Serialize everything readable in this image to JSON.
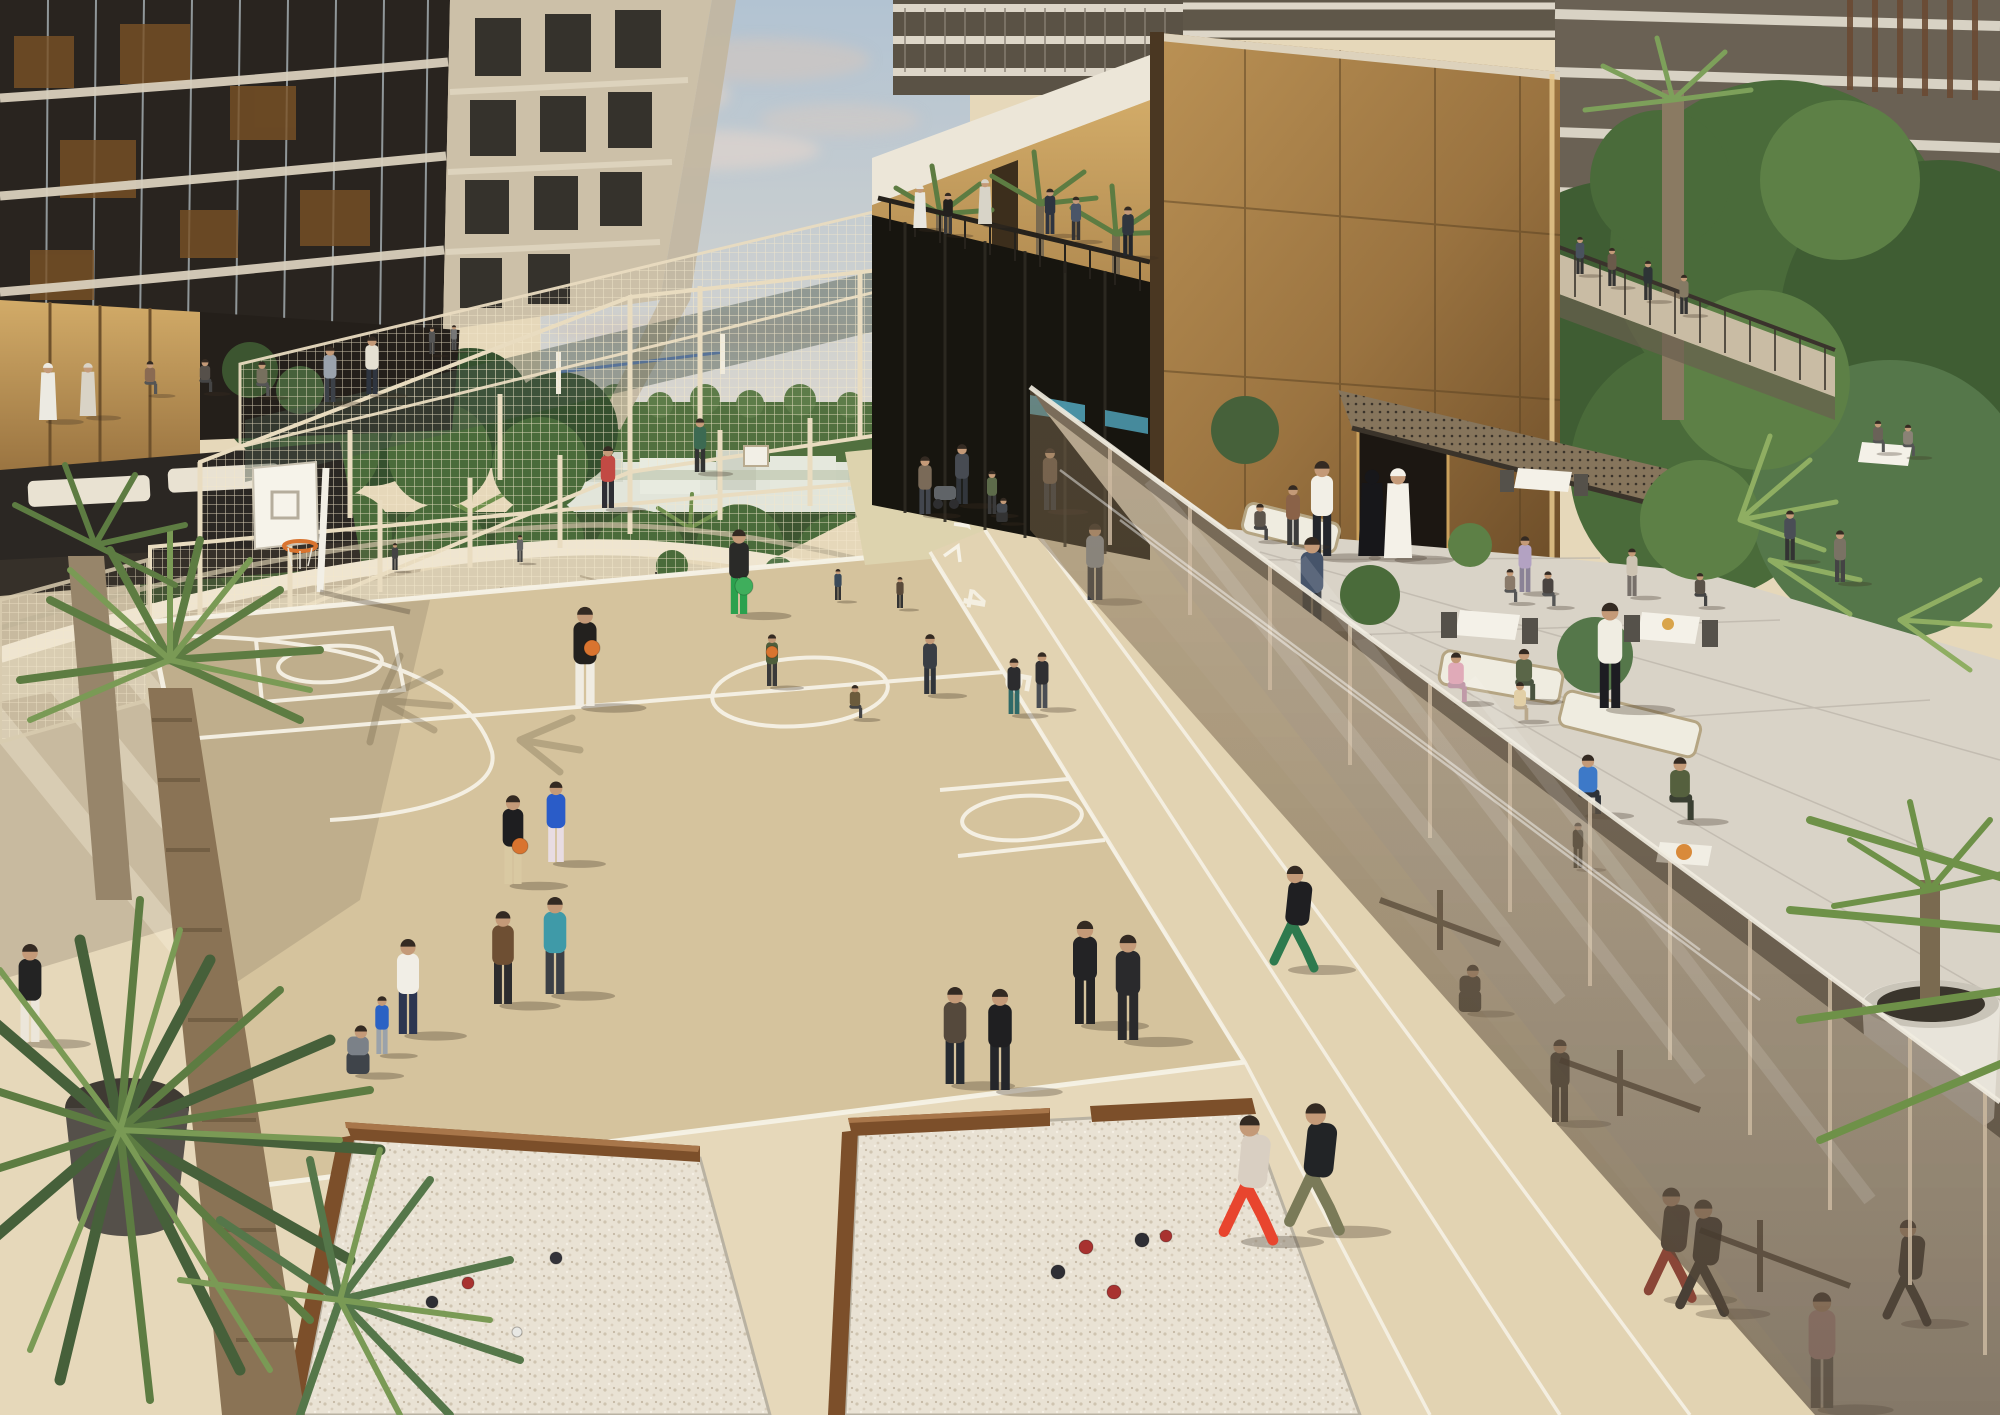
{
  "image": {
    "title": "Rooftop sports and leisure deck - architectural rendering",
    "width": 2000,
    "height": 1415
  },
  "scene": {
    "description": "Aerial rendering of a residential rooftop podium: basketball court with players, fenced padel courts, jogging track with painted lane numbers, two petanque sand pits, palm trees, a bronze pavilion and monolith volume, an outdoor restaurant terrace with diners and waiters behind a tinted glass balustrade, and an outdoor gym seen through the glass.",
    "areas": [
      "basketball-court",
      "padel-courts",
      "running-track",
      "petanque-pits",
      "restaurant-terrace",
      "balcony-pavilion",
      "outdoor-gym",
      "garden-walkway"
    ],
    "track": {
      "lane_numbers": [
        "4",
        "5",
        "3"
      ]
    },
    "palette": {
      "sky_top": "#b2c3d2",
      "sky_low": "#e6dccf",
      "cloud": "#d8cfc9",
      "horizon_green": "#51703f",
      "buildings_far": "#e2e5da",
      "tower_glass": "#29241f",
      "tower_glass_warm": "#7a5226",
      "tower_stone": "#ccc0a8",
      "bronze_light": "#c79e5f",
      "bronze_dark": "#8a6435",
      "canopy_white": "#ece6d8",
      "mesh": "#ecdfc2",
      "deck": "#e6d8ba",
      "court": "#d5c39d",
      "walk_light": "#efe3cb",
      "line_white": "#f6f2e6",
      "glass_tint": "#857258",
      "terrace_stone": "#d9d3c7",
      "sand": "#e9e2d4",
      "wood": "#7c4f2a",
      "pool": "#55c3c6",
      "rim_orange": "#d9742f",
      "palm_green": "#5d7c42",
      "palm_light": "#8fae62",
      "trunk": "#8a7355"
    },
    "balls": [
      {
        "x": 592,
        "y": 648,
        "r": 8,
        "c": "#d9742f"
      },
      {
        "x": 520,
        "y": 846,
        "r": 8,
        "c": "#d9742f"
      },
      {
        "x": 744,
        "y": 586,
        "r": 9,
        "c": "#3fae5c"
      },
      {
        "x": 772,
        "y": 652,
        "r": 6,
        "c": "#d9742f"
      }
    ],
    "boules": [
      {
        "x": 468,
        "y": 1283,
        "r": 6,
        "c": "#a83230"
      },
      {
        "x": 432,
        "y": 1302,
        "r": 6,
        "c": "#2e2e34"
      },
      {
        "x": 517,
        "y": 1332,
        "r": 5,
        "c": "#e8e8e4"
      },
      {
        "x": 556,
        "y": 1258,
        "r": 6,
        "c": "#33333a"
      },
      {
        "x": 1086,
        "y": 1247,
        "r": 7,
        "c": "#a83230"
      },
      {
        "x": 1058,
        "y": 1272,
        "r": 7,
        "c": "#2e2e34"
      },
      {
        "x": 1142,
        "y": 1240,
        "r": 7,
        "c": "#2e2e34"
      },
      {
        "x": 1114,
        "y": 1292,
        "r": 7,
        "c": "#a83230"
      },
      {
        "x": 1166,
        "y": 1236,
        "r": 6,
        "c": "#a83230"
      }
    ],
    "people": [
      {
        "x": 920,
        "y": 228,
        "h": 42,
        "top": "#e8e6de",
        "legs": "#e8e6de",
        "pose": "stand",
        "layer": "far",
        "robe": true
      },
      {
        "x": 948,
        "y": 234,
        "h": 40,
        "top": "#23211e",
        "legs": "#3a3a3a",
        "pose": "stand",
        "layer": "far"
      },
      {
        "x": 985,
        "y": 224,
        "h": 44,
        "top": "#d8d4c8",
        "legs": "#d8d4c8",
        "pose": "stand",
        "layer": "far",
        "robe": true
      },
      {
        "x": 1050,
        "y": 234,
        "h": 44,
        "top": "#2e3440",
        "legs": "#2e3440",
        "pose": "stand",
        "layer": "far"
      },
      {
        "x": 1076,
        "y": 240,
        "h": 42,
        "top": "#4a5568",
        "legs": "#333333",
        "pose": "stand",
        "layer": "far"
      },
      {
        "x": 1128,
        "y": 256,
        "h": 48,
        "top": "#30363e",
        "legs": "#23262b",
        "pose": "stand",
        "layer": "far"
      },
      {
        "x": 1580,
        "y": 274,
        "h": 36,
        "top": "#49525e",
        "legs": "#333333",
        "pose": "stand",
        "layer": "far"
      },
      {
        "x": 1612,
        "y": 286,
        "h": 37,
        "top": "#6a5a4a",
        "legs": "#333333",
        "pose": "stand",
        "layer": "far"
      },
      {
        "x": 1648,
        "y": 300,
        "h": 38,
        "top": "#2e3436",
        "legs": "#333333",
        "pose": "stand",
        "layer": "far"
      },
      {
        "x": 1684,
        "y": 314,
        "h": 38,
        "top": "#857a64",
        "legs": "#333333",
        "pose": "stand",
        "layer": "far"
      },
      {
        "x": 48,
        "y": 420,
        "h": 56,
        "top": "#eceae2",
        "legs": "#eceae2",
        "pose": "stand",
        "layer": "far",
        "robe": true
      },
      {
        "x": 88,
        "y": 416,
        "h": 52,
        "top": "#d9d3c6",
        "legs": "#b5ab9a",
        "pose": "stand",
        "layer": "far",
        "robe": true
      },
      {
        "x": 150,
        "y": 394,
        "h": 40,
        "top": "#8a6a52",
        "legs": "#555555",
        "pose": "sit",
        "layer": "far"
      },
      {
        "x": 205,
        "y": 392,
        "h": 40,
        "top": "#56504a",
        "legs": "#444444",
        "pose": "sit",
        "layer": "far"
      },
      {
        "x": 262,
        "y": 396,
        "h": 42,
        "top": "#77705e",
        "legs": "#555555",
        "pose": "sit",
        "layer": "far"
      },
      {
        "x": 330,
        "y": 402,
        "h": 54,
        "top": "#9aa2ac",
        "legs": "#3c4148",
        "pose": "stand",
        "layer": "far"
      },
      {
        "x": 372,
        "y": 394,
        "h": 56,
        "top": "#e5e0d2",
        "legs": "#2f3540",
        "pose": "stand",
        "layer": "far"
      },
      {
        "x": 395,
        "y": 570,
        "h": 26,
        "top": "#444444",
        "legs": "#333333",
        "pose": "stand",
        "layer": "far"
      },
      {
        "x": 520,
        "y": 562,
        "h": 26,
        "top": "#666666",
        "legs": "#444444",
        "pose": "stand",
        "layer": "far"
      },
      {
        "x": 838,
        "y": 600,
        "h": 30,
        "top": "#3a4a5a",
        "legs": "#333333",
        "pose": "stand",
        "layer": "far"
      },
      {
        "x": 900,
        "y": 608,
        "h": 30,
        "top": "#5a4a3a",
        "legs": "#333333",
        "pose": "stand",
        "layer": "far"
      },
      {
        "x": 925,
        "y": 514,
        "h": 56,
        "top": "#7a6a58",
        "legs": "#42464e",
        "pose": "stand",
        "layer": "far"
      },
      {
        "x": 962,
        "y": 504,
        "h": 58,
        "top": "#474b52",
        "legs": "#32363c",
        "pose": "stand",
        "layer": "far"
      },
      {
        "x": 992,
        "y": 514,
        "h": 42,
        "top": "#5d6b4a",
        "legs": "#3a3a3a",
        "pose": "stand",
        "layer": "far"
      },
      {
        "x": 1002,
        "y": 522,
        "h": 36,
        "top": "#44484e",
        "legs": "#333333",
        "pose": "crouch",
        "layer": "far"
      },
      {
        "x": 1050,
        "y": 510,
        "h": 60,
        "top": "#6b5948",
        "legs": "#2f3339",
        "pose": "stand",
        "layer": "far"
      },
      {
        "x": 608,
        "y": 508,
        "h": 60,
        "top": "#c24a44",
        "legs": "#2e2e34",
        "pose": "stand",
        "layer": "far"
      },
      {
        "x": 700,
        "y": 472,
        "h": 52,
        "top": "#3c6a52",
        "legs": "#333333",
        "pose": "stand",
        "layer": "far"
      },
      {
        "x": 432,
        "y": 354,
        "h": 26,
        "top": "#555555",
        "legs": "#444444",
        "pose": "stand",
        "layer": "far"
      },
      {
        "x": 454,
        "y": 350,
        "h": 24,
        "top": "#777777",
        "legs": "#555555",
        "pose": "stand",
        "layer": "far"
      },
      {
        "x": 585,
        "y": 706,
        "h": 96,
        "top": "#23211e",
        "legs": "#f0ece2",
        "pose": "stand",
        "layer": "mid"
      },
      {
        "x": 513,
        "y": 884,
        "h": 86,
        "top": "#1e1e20",
        "legs": "#d9c9a2",
        "pose": "stand",
        "layer": "mid"
      },
      {
        "x": 556,
        "y": 862,
        "h": 78,
        "top": "#2a5cc8",
        "legs": "#e8dce2",
        "pose": "stand",
        "layer": "mid"
      },
      {
        "x": 739,
        "y": 614,
        "h": 82,
        "top": "#2a2a28",
        "legs": "#2ba14e",
        "pose": "stand",
        "layer": "mid"
      },
      {
        "x": 930,
        "y": 694,
        "h": 58,
        "top": "#3a3e44",
        "legs": "#30343a",
        "pose": "stand",
        "layer": "mid"
      },
      {
        "x": 772,
        "y": 686,
        "h": 50,
        "top": "#4e5e3c",
        "legs": "#3a3a3a",
        "pose": "stand",
        "layer": "mid"
      },
      {
        "x": 855,
        "y": 718,
        "h": 40,
        "top": "#6b5b3c",
        "legs": "#444444",
        "pose": "sit",
        "layer": "mid"
      },
      {
        "x": 1014,
        "y": 714,
        "h": 54,
        "top": "#2c2c2e",
        "legs": "#2f6a68",
        "pose": "stand",
        "layer": "mid"
      },
      {
        "x": 1042,
        "y": 708,
        "h": 54,
        "top": "#303032",
        "legs": "#4a4e54",
        "pose": "stand",
        "layer": "mid"
      },
      {
        "x": 1095,
        "y": 600,
        "h": 74,
        "top": "#9299a2",
        "legs": "#383c42",
        "pose": "stand",
        "layer": "mid"
      },
      {
        "x": 1292,
        "y": 968,
        "h": 100,
        "top": "#1f1f22",
        "legs": "#2e7a4e",
        "pose": "run",
        "layer": "mid"
      },
      {
        "x": 1322,
        "y": 556,
        "h": 92,
        "top": "#f2efe6",
        "legs": "#23262c",
        "pose": "stand",
        "layer": "mid"
      },
      {
        "x": 1372,
        "y": 556,
        "h": 86,
        "top": "#17171a",
        "legs": "#17171a",
        "pose": "stand",
        "layer": "mid",
        "robe": true,
        "head": "#17171a"
      },
      {
        "x": 1398,
        "y": 558,
        "h": 88,
        "top": "#f4f1e8",
        "legs": "#f4f1e8",
        "pose": "stand",
        "layer": "mid",
        "robe": true
      },
      {
        "x": 1293,
        "y": 545,
        "h": 58,
        "top": "#8a6248",
        "legs": "#3c3c3c",
        "pose": "stand",
        "layer": "mid"
      },
      {
        "x": 1260,
        "y": 540,
        "h": 44,
        "top": "#5c554c",
        "legs": "#444444",
        "pose": "sit",
        "layer": "mid"
      },
      {
        "x": 1312,
        "y": 634,
        "h": 94,
        "top": "#46546a",
        "legs": "#2c3036",
        "pose": "stand",
        "layer": "mid"
      },
      {
        "x": 1525,
        "y": 592,
        "h": 54,
        "top": "#b3a2c2",
        "legs": "#8a8296",
        "pose": "stand",
        "layer": "mid"
      },
      {
        "x": 1510,
        "y": 602,
        "h": 40,
        "top": "#8a7a6a",
        "legs": "#555555",
        "pose": "sit",
        "layer": "mid"
      },
      {
        "x": 1548,
        "y": 606,
        "h": 42,
        "top": "#4a4440",
        "legs": "#555555",
        "pose": "sit",
        "layer": "mid"
      },
      {
        "x": 1632,
        "y": 596,
        "h": 46,
        "top": "#cdc3b2",
        "legs": "#77706a",
        "pose": "stand",
        "layer": "mid"
      },
      {
        "x": 1700,
        "y": 606,
        "h": 40,
        "top": "#5a5248",
        "legs": "#444444",
        "pose": "sit",
        "layer": "mid"
      },
      {
        "x": 1610,
        "y": 708,
        "h": 102,
        "top": "#f0ede2",
        "legs": "#1d1d22",
        "pose": "stand",
        "layer": "mid"
      },
      {
        "x": 1456,
        "y": 702,
        "h": 60,
        "top": "#e0aab8",
        "legs": "#c09aa8",
        "pose": "sit",
        "layer": "mid"
      },
      {
        "x": 1524,
        "y": 700,
        "h": 62,
        "top": "#5a6648",
        "legs": "#4a5440",
        "pose": "sit",
        "layer": "mid"
      },
      {
        "x": 1520,
        "y": 720,
        "h": 46,
        "top": "#e2cfa6",
        "legs": "#b9a88c",
        "pose": "sit",
        "layer": "mid"
      },
      {
        "x": 1588,
        "y": 814,
        "h": 72,
        "top": "#3d79c8",
        "legs": "#2e3238",
        "pose": "sit",
        "layer": "mid"
      },
      {
        "x": 1680,
        "y": 820,
        "h": 76,
        "top": "#55603e",
        "legs": "#3a3f32",
        "pose": "sit",
        "layer": "mid"
      },
      {
        "x": 1878,
        "y": 452,
        "h": 38,
        "top": "#6a6258",
        "legs": "#555555",
        "pose": "sit",
        "layer": "mid"
      },
      {
        "x": 1908,
        "y": 456,
        "h": 38,
        "top": "#8a8276",
        "legs": "#555555",
        "pose": "sit",
        "layer": "mid"
      },
      {
        "x": 1790,
        "y": 560,
        "h": 48,
        "top": "#4a4e56",
        "legs": "#333333",
        "pose": "stand",
        "layer": "mid"
      },
      {
        "x": 1840,
        "y": 582,
        "h": 50,
        "top": "#7a7264",
        "legs": "#444444",
        "pose": "stand",
        "layer": "mid"
      },
      {
        "x": 30,
        "y": 1042,
        "h": 95,
        "top": "#232323",
        "legs": "#ece6da",
        "pose": "stand",
        "layer": "near"
      },
      {
        "x": 358,
        "y": 1074,
        "h": 72,
        "top": "#7b8188",
        "legs": "#3f444a",
        "pose": "crouch",
        "layer": "near"
      },
      {
        "x": 382,
        "y": 1054,
        "h": 56,
        "top": "#2a62c4",
        "legs": "#9aa2aa",
        "pose": "stand",
        "layer": "near"
      },
      {
        "x": 408,
        "y": 1034,
        "h": 92,
        "top": "#f1eee6",
        "legs": "#2c3550",
        "pose": "stand",
        "layer": "near"
      },
      {
        "x": 503,
        "y": 1004,
        "h": 90,
        "top": "#6e4f33",
        "legs": "#2c2c2e",
        "pose": "stand",
        "layer": "near"
      },
      {
        "x": 555,
        "y": 994,
        "h": 94,
        "top": "#3f9aa8",
        "legs": "#3c4046",
        "pose": "stand",
        "layer": "near"
      },
      {
        "x": 1085,
        "y": 1024,
        "h": 100,
        "top": "#232325",
        "legs": "#232325",
        "pose": "stand",
        "layer": "near"
      },
      {
        "x": 1128,
        "y": 1040,
        "h": 102,
        "top": "#2a2a2c",
        "legs": "#2a2a2c",
        "pose": "stand",
        "layer": "near"
      },
      {
        "x": 955,
        "y": 1084,
        "h": 94,
        "top": "#55493c",
        "legs": "#262b31",
        "pose": "stand",
        "layer": "near"
      },
      {
        "x": 1000,
        "y": 1090,
        "h": 98,
        "top": "#1f1f21",
        "legs": "#24262a",
        "pose": "stand",
        "layer": "near"
      },
      {
        "x": 1246,
        "y": 1240,
        "h": 122,
        "top": "#d9cfc2",
        "legs": "#e8452e",
        "pose": "run",
        "layer": "near"
      },
      {
        "x": 1312,
        "y": 1230,
        "h": 124,
        "top": "#222426",
        "legs": "#7a7a58",
        "pose": "run",
        "layer": "near"
      },
      {
        "x": 1668,
        "y": 1298,
        "h": 108,
        "top": "#3a3026",
        "legs": "#7a2e22",
        "pose": "run",
        "layer": "glass"
      },
      {
        "x": 1700,
        "y": 1312,
        "h": 110,
        "top": "#2e2620",
        "legs": "#2e2620",
        "pose": "run",
        "layer": "glass"
      },
      {
        "x": 1822,
        "y": 1408,
        "h": 112,
        "top": "#caa09a",
        "legs": "#6e665c",
        "pose": "stand",
        "layer": "glass"
      },
      {
        "x": 1470,
        "y": 1012,
        "h": 70,
        "top": "#3a342c",
        "legs": "#3a342c",
        "pose": "crouch",
        "layer": "glass"
      },
      {
        "x": 1560,
        "y": 1122,
        "h": 80,
        "top": "#332e26",
        "legs": "#332e26",
        "pose": "stand",
        "layer": "glass"
      },
      {
        "x": 1905,
        "y": 1322,
        "h": 100,
        "top": "#2c2822",
        "legs": "#2c2822",
        "pose": "run",
        "layer": "glass"
      },
      {
        "x": 1578,
        "y": 868,
        "h": 44,
        "top": "#3c382e",
        "legs": "#3c382e",
        "pose": "stand",
        "layer": "glass"
      }
    ]
  }
}
